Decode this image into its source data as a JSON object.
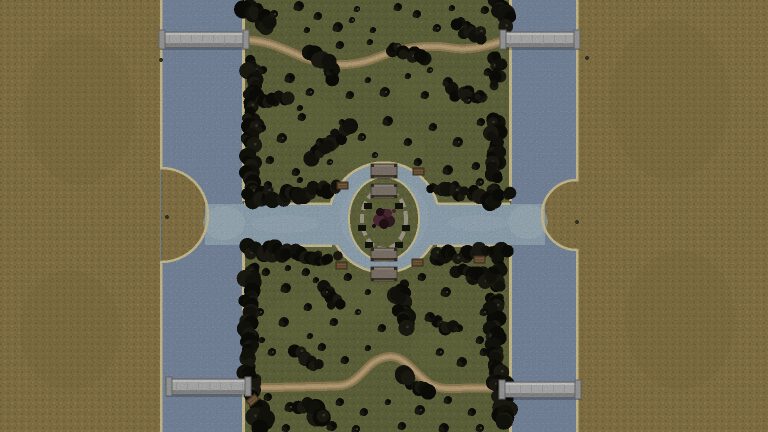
{
  "scene": {
    "description": "Top-down game terrain: two vertical rivers with stone girder bridges flanking a wooded park strip, central circular moat with garden island, winding dirt trails",
    "view": "overhead-map"
  },
  "palette": {
    "sand_ground": "#97834f",
    "sand_ground_dark": "#877544",
    "sand_ground_light": "#a28e57",
    "shore_edge": "#e3d6a2",
    "shore_edge_bright": "#f0e6c0",
    "river_water": "#8698b1",
    "canal_water": "#a3b8c8",
    "shallow_water": "#b9cbd6",
    "grass": "#6c7244",
    "grass_dark": "#5f653c",
    "grass_light": "#777d4b",
    "tree_dark": "#0d0d08",
    "tree_mid": "#15150e",
    "tree_soft": "#1e1e14",
    "tree_highlight": "#46412f",
    "path_edge": "#aa9063",
    "path_mid": "#c5a97b",
    "path_center": "#d5bc8f",
    "bridge_deck": "#c3c3c3",
    "bridge_light": "#dedede",
    "bridge_dark": "#989898",
    "bridge_outline": "#767676",
    "bridge_cap": "#aeaeae",
    "wood_deck": "#8e8478",
    "wood_edge": "#564a3d",
    "wood_post": "#3a332a",
    "wood_line": "#4a4034",
    "bench_wood": "#6f5638",
    "bench_edge": "#473522",
    "bench_slat": "#8a6b45",
    "ring_path": "#b5ae9b",
    "garden_dark": "#241218",
    "garden_red": "#552e3a",
    "garden_mid": "#3a1f28",
    "ornament": "#16160f"
  },
  "geometry": {
    "canvas": {
      "w": 768,
      "h": 432
    },
    "green_left": 243,
    "green_right": 511,
    "left_river": [
      160,
      243
    ],
    "right_river": [
      511,
      577
    ],
    "left_bulge": {
      "cx": 157,
      "cy": 215,
      "r": 47
    },
    "right_bulge": {
      "cx": 581,
      "cy": 215,
      "r": 35
    },
    "canal": {
      "x1": 205,
      "x2": 545,
      "y1": 204,
      "y2": 245
    },
    "pond": {
      "cx": 384,
      "cy": 217.5,
      "r": 55
    },
    "island": {
      "cx": 384,
      "cy": 219,
      "rx": 35,
      "ry": 42,
      "ring_rx": 22,
      "ring_ry": 30
    }
  },
  "features": {
    "road_bridges": [
      {
        "name": "bridge-north-west",
        "x": 159,
        "y": 32,
        "w": 90,
        "h": 15
      },
      {
        "name": "bridge-north-east",
        "x": 500,
        "y": 32,
        "w": 80,
        "h": 15
      },
      {
        "name": "bridge-south-west",
        "x": 166,
        "y": 379,
        "w": 85,
        "h": 15
      },
      {
        "name": "bridge-south-east",
        "x": 499,
        "y": 382,
        "w": 82,
        "h": 15
      }
    ],
    "wooden_bridges": [
      {
        "name": "moat-bridge-north-outer",
        "x": 371,
        "y": 164,
        "w": 26,
        "h": 14
      },
      {
        "name": "moat-bridge-north-inner",
        "x": 371,
        "y": 184,
        "w": 26,
        "h": 14
      },
      {
        "name": "moat-bridge-south-inner",
        "x": 371,
        "y": 248,
        "w": 26,
        "h": 13
      },
      {
        "name": "moat-bridge-south-outer",
        "x": 371,
        "y": 267,
        "w": 26,
        "h": 14
      }
    ],
    "benches": [
      {
        "x": 337,
        "y": 182,
        "rot": 0
      },
      {
        "x": 413,
        "y": 168,
        "rot": 0
      },
      {
        "x": 336,
        "y": 262,
        "rot": 0
      },
      {
        "x": 412,
        "y": 259,
        "rot": 0
      },
      {
        "x": 474,
        "y": 256,
        "rot": 0
      },
      {
        "x": 247,
        "y": 397,
        "rot": -40
      }
    ],
    "ornaments": [
      [
        368,
        206
      ],
      [
        399,
        206
      ],
      [
        362,
        228
      ],
      [
        406,
        228
      ],
      [
        369,
        245
      ],
      [
        399,
        245
      ]
    ],
    "garden_bush": [
      [
        384,
        216,
        7,
        "garden_mid"
      ],
      [
        379,
        220,
        6,
        "garden_red"
      ],
      [
        389,
        221,
        6,
        "garden_mid"
      ],
      [
        384,
        224,
        5,
        "garden_dark"
      ],
      [
        388,
        213,
        4,
        "garden_red"
      ],
      [
        380,
        212,
        4,
        "garden_dark"
      ],
      [
        374,
        226,
        2,
        "garden_dark"
      ],
      [
        394,
        211,
        2,
        "garden_red"
      ]
    ],
    "paths": {
      "north": "M247,40 C268,41 282,48 298,55 C314,62 332,66 352,64 C372,62 382,54 400,50 C418,46 434,45 452,48 C470,51 487,46 503,41",
      "south": "M251,388 L338,386 C352,385 358,377 368,367 C376,359 388,354 398,358 C408,362 418,376 430,384 C442,391 458,388 470,388 L503,388"
    },
    "hedges": [
      [
        246,
        3,
        264,
        26,
        15
      ],
      [
        251,
        60,
        252,
        100,
        14
      ],
      [
        253,
        99,
        289,
        98,
        11
      ],
      [
        252,
        104,
        251,
        152,
        14
      ],
      [
        251,
        152,
        252,
        200,
        14
      ],
      [
        497,
        3,
        509,
        24,
        15
      ],
      [
        498,
        56,
        496,
        86,
        11
      ],
      [
        495,
        118,
        495,
        160,
        13
      ],
      [
        495,
        160,
        494,
        200,
        13
      ],
      [
        308,
        158,
        348,
        131,
        13
      ],
      [
        312,
        54,
        336,
        74,
        14
      ],
      [
        393,
        47,
        423,
        57,
        12
      ],
      [
        458,
        26,
        484,
        38,
        12
      ],
      [
        455,
        92,
        478,
        99,
        11
      ],
      [
        248,
        197,
        298,
        194,
        13
      ],
      [
        298,
        194,
        336,
        186,
        12
      ],
      [
        430,
        188,
        468,
        194,
        12
      ],
      [
        468,
        194,
        507,
        198,
        13
      ],
      [
        248,
        251,
        298,
        253,
        13
      ],
      [
        298,
        253,
        334,
        260,
        12
      ],
      [
        432,
        258,
        468,
        254,
        12
      ],
      [
        468,
        254,
        508,
        252,
        13
      ],
      [
        250,
        266,
        249,
        330,
        14
      ],
      [
        249,
        330,
        251,
        394,
        14
      ],
      [
        252,
        394,
        262,
        426,
        16
      ],
      [
        496,
        262,
        494,
        330,
        13
      ],
      [
        494,
        330,
        497,
        378,
        13
      ],
      [
        498,
        378,
        507,
        426,
        15
      ],
      [
        399,
        285,
        404,
        328,
        14
      ],
      [
        302,
        400,
        322,
        418,
        16
      ],
      [
        437,
        320,
        456,
        330,
        11
      ],
      [
        460,
        270,
        488,
        280,
        12
      ],
      [
        296,
        352,
        320,
        366,
        12
      ],
      [
        402,
        370,
        426,
        392,
        15
      ],
      [
        328,
        286,
        336,
        308,
        12
      ]
    ],
    "trees": [
      [
        258,
        8,
        5
      ],
      [
        274,
        14,
        4
      ],
      [
        299,
        6,
        5
      ],
      [
        318,
        16,
        4
      ],
      [
        338,
        27,
        5
      ],
      [
        357,
        9,
        3
      ],
      [
        373,
        30,
        3
      ],
      [
        398,
        7,
        4
      ],
      [
        417,
        14,
        4
      ],
      [
        437,
        28,
        4
      ],
      [
        452,
        8,
        3
      ],
      [
        467,
        25,
        4
      ],
      [
        485,
        10,
        4
      ],
      [
        352,
        20,
        3
      ],
      [
        307,
        30,
        3
      ],
      [
        290,
        78,
        5
      ],
      [
        263,
        70,
        4
      ],
      [
        310,
        92,
        4
      ],
      [
        330,
        72,
        4
      ],
      [
        350,
        95,
        4
      ],
      [
        368,
        80,
        3
      ],
      [
        385,
        92,
        5
      ],
      [
        408,
        76,
        3
      ],
      [
        425,
        95,
        4
      ],
      [
        448,
        82,
        5
      ],
      [
        468,
        100,
        4
      ],
      [
        488,
        72,
        4
      ],
      [
        300,
        108,
        3
      ],
      [
        340,
        45,
        4
      ],
      [
        430,
        70,
        3
      ],
      [
        370,
        42,
        3
      ],
      [
        480,
        95,
        5
      ],
      [
        262,
        128,
        4
      ],
      [
        282,
        138,
        5
      ],
      [
        302,
        117,
        4
      ],
      [
        320,
        142,
        4
      ],
      [
        342,
        122,
        3
      ],
      [
        362,
        137,
        4
      ],
      [
        388,
        121,
        5
      ],
      [
        408,
        142,
        4
      ],
      [
        433,
        127,
        4
      ],
      [
        458,
        142,
        5
      ],
      [
        481,
        122,
        4
      ],
      [
        270,
        160,
        4
      ],
      [
        296,
        172,
        4
      ],
      [
        330,
        162,
        3
      ],
      [
        418,
        162,
        4
      ],
      [
        448,
        170,
        5
      ],
      [
        476,
        166,
        4
      ],
      [
        375,
        155,
        3
      ],
      [
        268,
        185,
        4
      ],
      [
        300,
        180,
        3
      ],
      [
        455,
        185,
        4
      ],
      [
        480,
        182,
        4
      ],
      [
        266,
        272,
        4
      ],
      [
        286,
        288,
        5
      ],
      [
        306,
        272,
        4
      ],
      [
        326,
        292,
        4
      ],
      [
        348,
        277,
        4
      ],
      [
        368,
        292,
        3
      ],
      [
        422,
        277,
        4
      ],
      [
        446,
        292,
        5
      ],
      [
        470,
        277,
        4
      ],
      [
        288,
        268,
        3
      ],
      [
        316,
        280,
        3
      ],
      [
        260,
        312,
        4
      ],
      [
        284,
        322,
        5
      ],
      [
        308,
        307,
        4
      ],
      [
        334,
        322,
        4
      ],
      [
        358,
        312,
        3
      ],
      [
        382,
        328,
        4
      ],
      [
        430,
        317,
        5
      ],
      [
        458,
        328,
        4
      ],
      [
        484,
        312,
        4
      ],
      [
        262,
        340,
        3
      ],
      [
        310,
        336,
        3
      ],
      [
        480,
        340,
        4
      ],
      [
        272,
        352,
        4
      ],
      [
        322,
        347,
        4
      ],
      [
        345,
        360,
        4
      ],
      [
        368,
        348,
        3
      ],
      [
        440,
        352,
        4
      ],
      [
        462,
        362,
        5
      ],
      [
        484,
        352,
        4
      ],
      [
        268,
        397,
        4
      ],
      [
        290,
        407,
        5
      ],
      [
        340,
        402,
        4
      ],
      [
        364,
        412,
        4
      ],
      [
        388,
        402,
        3
      ],
      [
        420,
        410,
        5
      ],
      [
        448,
        400,
        4
      ],
      [
        472,
        412,
        4
      ],
      [
        332,
        426,
        5
      ],
      [
        356,
        429,
        4
      ],
      [
        402,
        426,
        4
      ],
      [
        444,
        428,
        5
      ],
      [
        286,
        428,
        4
      ],
      [
        480,
        428,
        4
      ]
    ],
    "ground_specks": [
      [
        161,
        60
      ],
      [
        167,
        217
      ],
      [
        587,
        58
      ],
      [
        577,
        222
      ]
    ],
    "grass_patches": [
      [
        300,
        120,
        40,
        25
      ],
      [
        430,
        92,
        35,
        20
      ],
      [
        302,
        320,
        38,
        22
      ],
      [
        440,
        350,
        30,
        18
      ],
      [
        380,
        150,
        45,
        22
      ],
      [
        350,
        300,
        40,
        20
      ]
    ],
    "sand_patches": [
      [
        80,
        110,
        55,
        75
      ],
      [
        70,
        330,
        50,
        60
      ],
      [
        670,
        100,
        60,
        80
      ],
      [
        680,
        320,
        55,
        70
      ]
    ]
  }
}
